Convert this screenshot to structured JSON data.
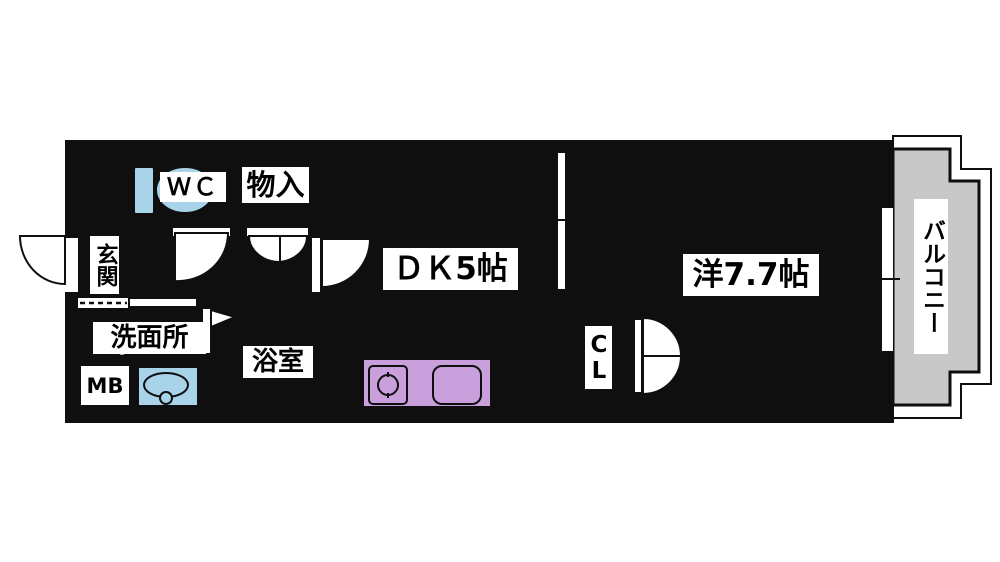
{
  "type": "apartment-floor-plan",
  "rooms": {
    "wc": {
      "label": "ＷＣ"
    },
    "storage": {
      "label": "物入"
    },
    "entrance": {
      "label": "玄関"
    },
    "washroom": {
      "label": "洗面所"
    },
    "meter_box": {
      "label": "MB"
    },
    "bathroom": {
      "label": "浴室"
    },
    "dining_kitchen": {
      "label": "ＤＫ5帖",
      "size_jo": 5
    },
    "western_room": {
      "label": "洋7.7帖",
      "size_jo": 7.7
    },
    "closet": {
      "label": "CL"
    },
    "balcony": {
      "label": "バルコニー"
    }
  },
  "icons": {
    "toilet": "toilet-icon",
    "bathtub": "bathtub-icon",
    "washing_machine_pan": "washing-machine-pan-icon",
    "vanity_sink": "vanity-sink-icon",
    "stove": "stove-burner-icon",
    "kitchen_sink": "kitchen-sink-icon",
    "refrigerator_space": "refrigerator-dashed-box-icon",
    "door_swings": "door-swing-arc-icon",
    "sliding_partition": "sliding-door-icon",
    "window": "sliding-window-icon",
    "folding_bath_door": "folding-door-flag-icon"
  },
  "colors": {
    "floor": "#dde58c",
    "water": "#a8d3e9",
    "tan": "#e3c69e",
    "purple": "#c9a0dc",
    "balcony": "#c8c8c8",
    "tile": "#bcbcbc",
    "cream": "#f2e7cc",
    "wall": "#0f0f0f"
  }
}
